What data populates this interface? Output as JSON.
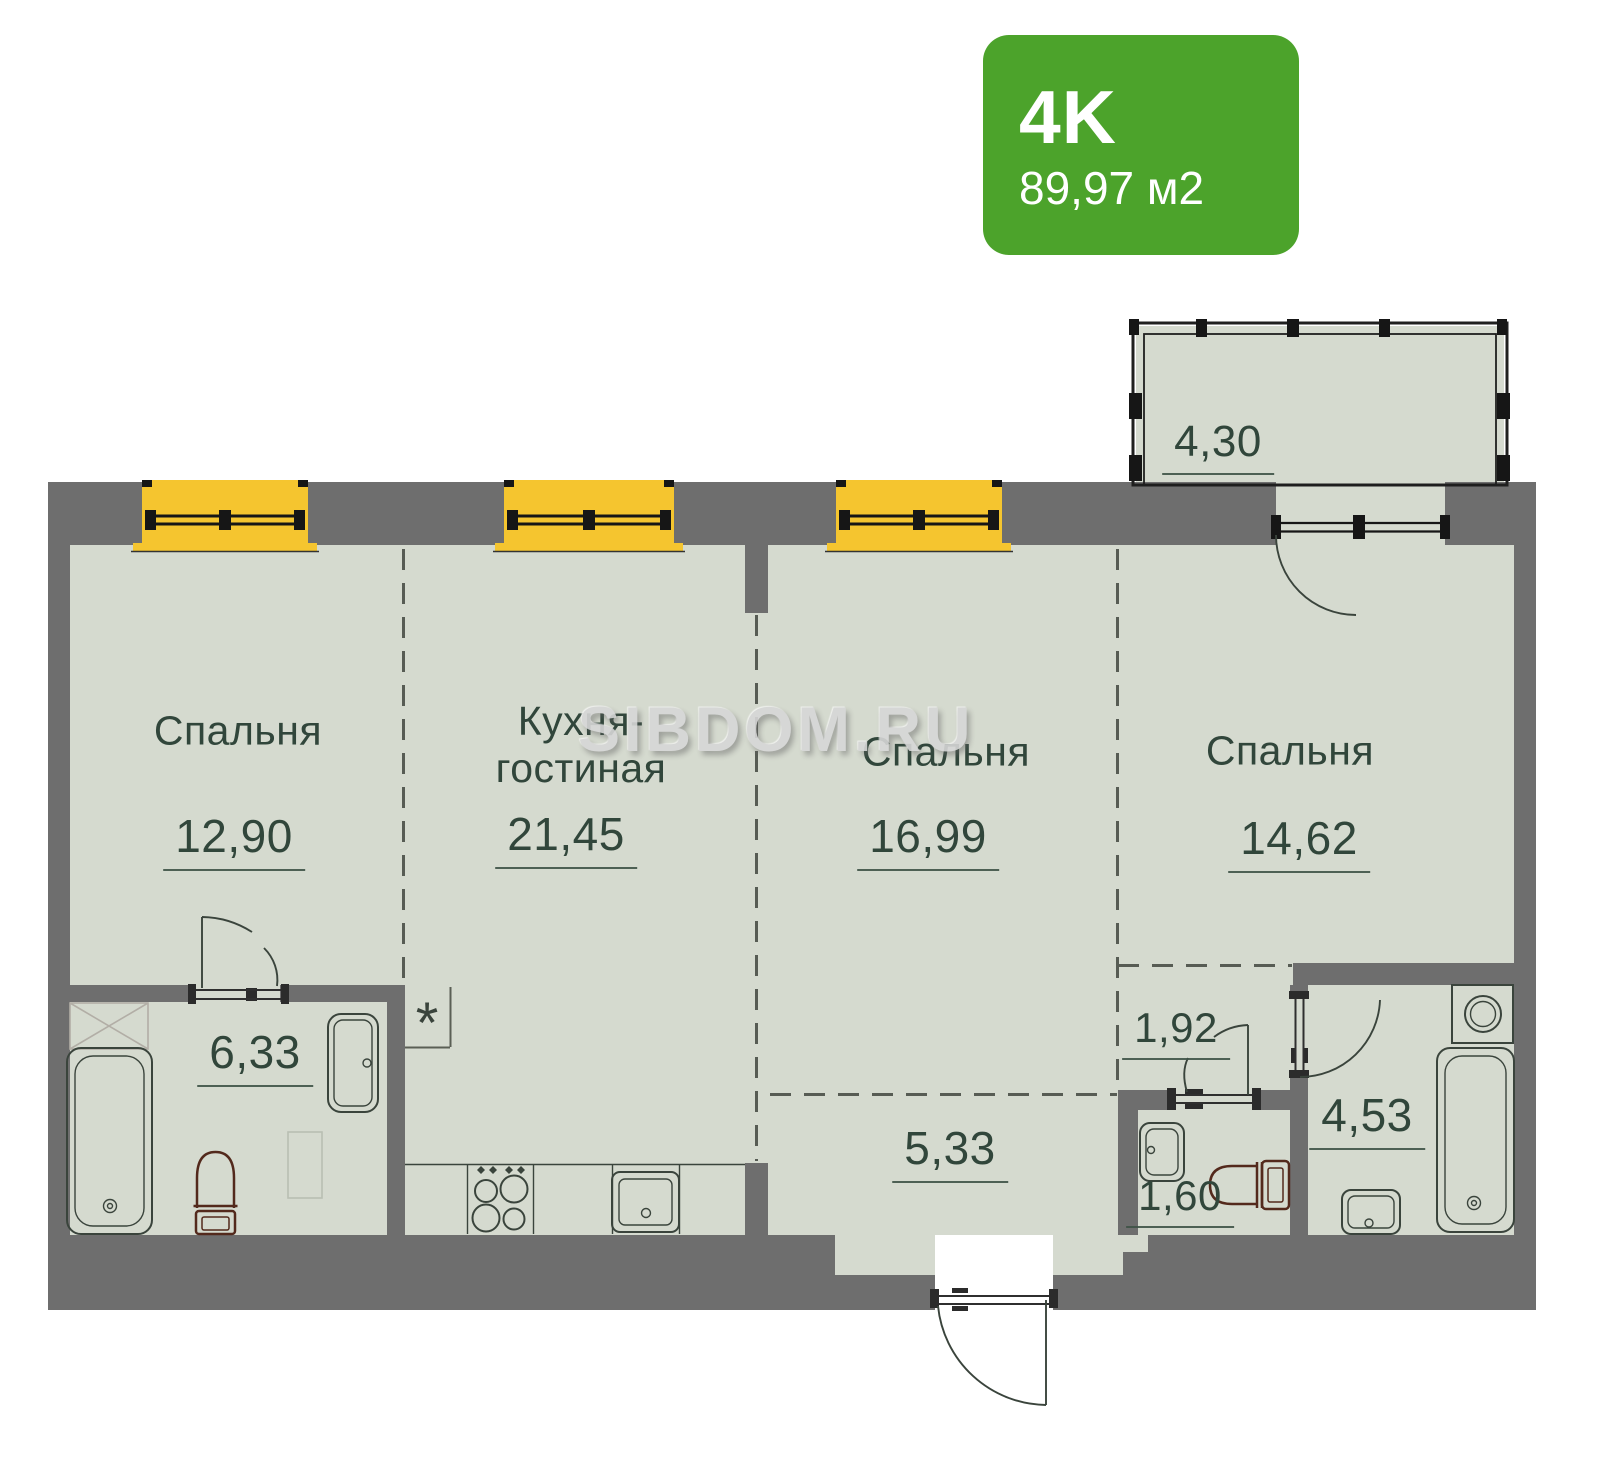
{
  "badge": {
    "type": "4K",
    "area": "89,97 м2"
  },
  "watermark": "SIBDOM.RU",
  "kitchen_marker": "*",
  "colors": {
    "badge_green": "#4CA32B",
    "window_yellow": "#F5C52F",
    "floor": "#D5DACF",
    "wall": "#6E6E6E",
    "line": "#3A443C",
    "text": "#31463B",
    "toilet": "#53291C"
  },
  "rooms": {
    "bedroom1": {
      "name": "Спальня",
      "area": "12,90"
    },
    "kitchen": {
      "name_line1": "Кухня-",
      "name_line2": "гостиная",
      "area": "21,45"
    },
    "bedroom2": {
      "name": "Спальня",
      "area": "16,99"
    },
    "bedroom3": {
      "name": "Спальня",
      "area": "14,62"
    },
    "balcony": {
      "area": "4,30"
    },
    "bathroom_main": {
      "area": "6,33"
    },
    "hallway": {
      "area": "5,33"
    },
    "corridor": {
      "area": "1,92"
    },
    "bathroom_second": {
      "area": "4,53"
    },
    "wc": {
      "area": "1,60"
    }
  }
}
